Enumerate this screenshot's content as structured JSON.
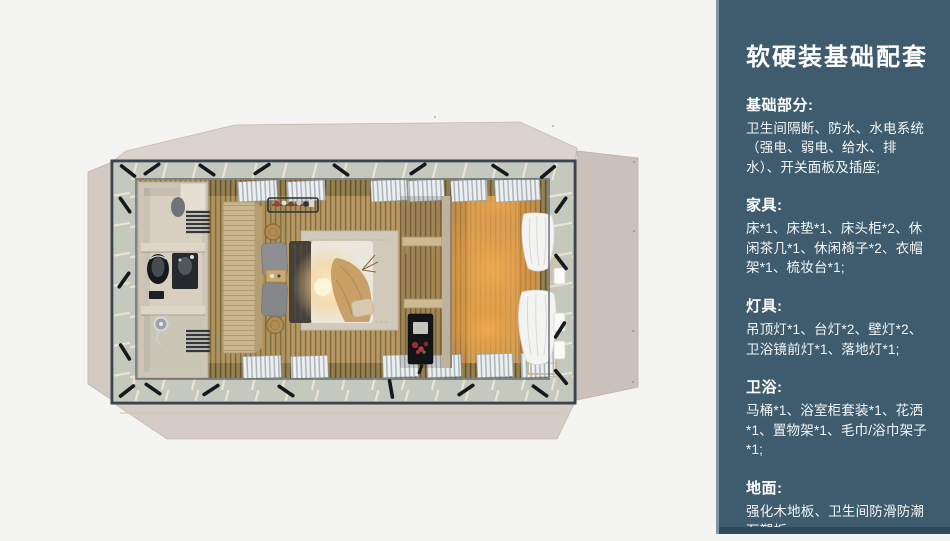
{
  "page": {
    "background": "#f4f4f3"
  },
  "sidebar": {
    "background": "#3e5c6d",
    "accent_strip": "#7e97a4",
    "footer_strip": "#2e4a59",
    "text_color": "#ffffff",
    "title": "软硬装基础配套",
    "sections": [
      {
        "heading": "基础部分:",
        "body": "卫生间隔断、防水、水电系统（强电、弱电、给水、排水）、开关面板及插座;"
      },
      {
        "heading": "家具:",
        "body": "床*1、床垫*1、床头柜*2、休闲茶几*1、休闲椅子*2、衣帽架*1、梳妆台*1;"
      },
      {
        "heading": "灯具:",
        "body": "吊顶灯*1、台灯*2、壁灯*2、卫浴镜前灯*1、落地灯*1;"
      },
      {
        "heading": "卫浴:",
        "body": "马桶*1、浴室柜套装*1、花洒*1、置物架*1、毛巾/浴巾架子*1;"
      },
      {
        "heading": "地面:",
        "body": "强化木地板、卫生间防滑防潮石塑板;"
      }
    ]
  },
  "floorplan": {
    "view": "top-down render of a prefab guest room with bedroom and ensuite bathroom",
    "colors": {
      "exterior_panel": "#d6cec6",
      "steel_frame": "#3a434e",
      "frame_band": "#c5c8bd",
      "floor_wood": "#b0905a",
      "wall_slats": "#8a774a",
      "lamp_glow": "#f2a94e",
      "rug": "#d1cabb",
      "bed_duvet": "#ece7dc",
      "bathroom_shell": "#cdc5b6"
    }
  }
}
